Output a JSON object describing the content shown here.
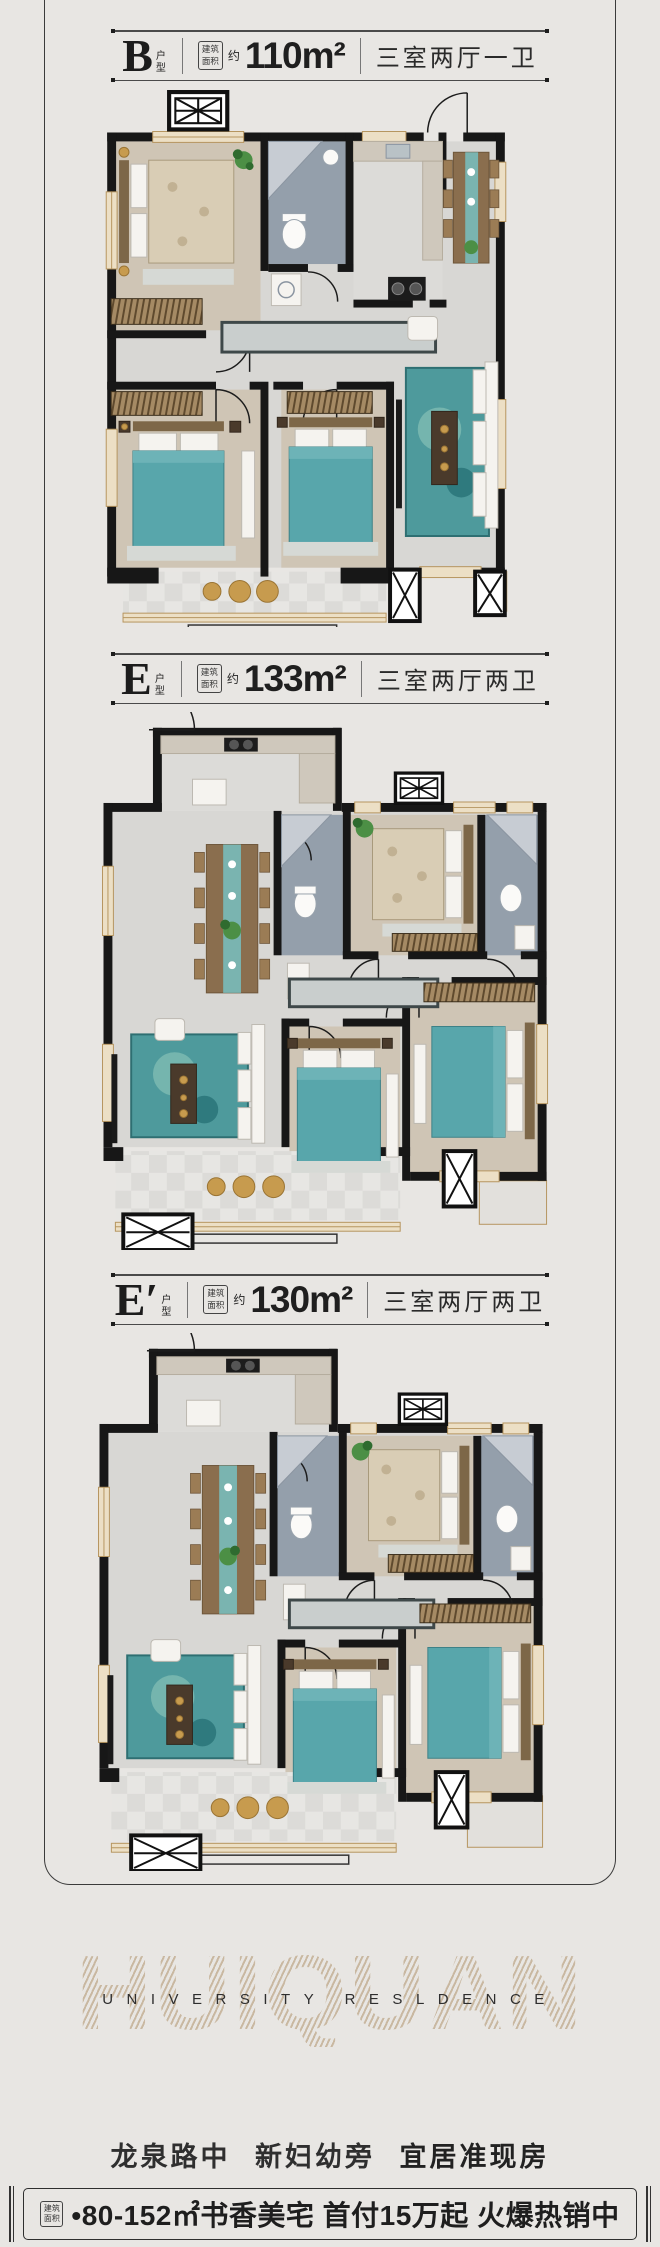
{
  "plans": [
    {
      "letter": "B",
      "type_stack": "户型",
      "area_tag": "建筑面积",
      "approx": "约",
      "area": "110m²",
      "rooms": "三室两厅一卫"
    },
    {
      "letter": "E",
      "type_stack": "户型",
      "area_tag": "建筑面积",
      "approx": "约",
      "area": "133m²",
      "rooms": "三室两厅两卫"
    },
    {
      "letter": "E′",
      "type_stack": "户型",
      "area_tag": "建筑面积",
      "approx": "约",
      "area": "130m²",
      "rooms": "三室两厅两卫"
    }
  ],
  "footer": {
    "watermark": "HUIQUAN",
    "subtitle": "UNIVERSITY RESLDENCE",
    "headline_parts": [
      "龙泉路中",
      "新妇幼旁",
      "宜居准现房"
    ],
    "banner_area_tag": "建筑面积",
    "banner_text": "•80-152㎡书香美宅 首付15万起 火爆热销中",
    "hotline_label": "品鉴专线",
    "hotline_code": "0632",
    "hotline_number": "5570 966",
    "addresses": [
      {
        "label": "项目地址：",
        "value": "龙泉路东 新妇幼东门对面"
      },
      {
        "label": "营销中心：",
        "value": "新妇幼保健院北门对面"
      }
    ]
  },
  "colors": {
    "accent_teal": "#58a6ab",
    "wood": "#cfc5b5",
    "watermark_tan": "#c4b196",
    "wall": "#171717"
  }
}
